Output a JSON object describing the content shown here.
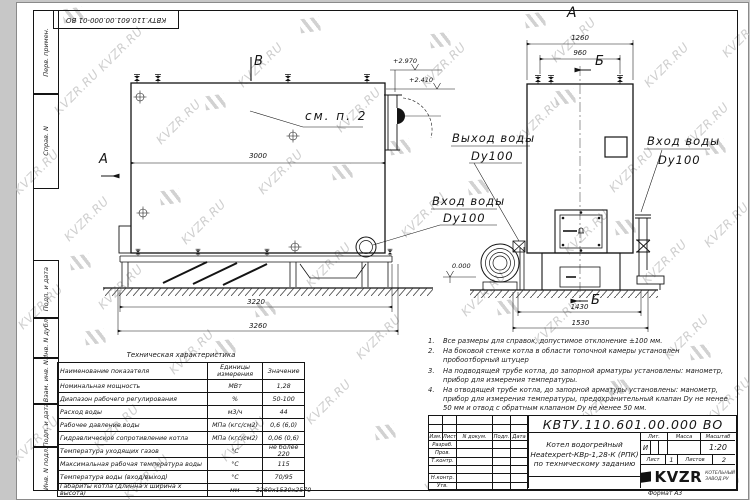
{
  "watermark": {
    "text": "KVZR.RU",
    "color": "#c6c6c6"
  },
  "colors": {
    "paper": "#ffffff",
    "line": "#141414",
    "background": "#c7c7c7"
  },
  "stamp_top": "КВТУ.110.601.00.000-01  ВО",
  "sidebar": {
    "labels": [
      "Перв. примен.",
      "Справ. N",
      "Подп. и дата",
      "Инв. N дубл.",
      "Взам. инв. N",
      "Подп. и дата",
      "Инв. N подл."
    ]
  },
  "side_view": {
    "marker_b": "В",
    "marker_a": "А",
    "elev_top": "+2.970",
    "elev_mid": "+2.410",
    "note_ref": "см. п. 2",
    "dim_width": "3000",
    "dim_base": "3220",
    "dim_total": "3260"
  },
  "front_view": {
    "marker_a": "А",
    "marker_b_top": "Б",
    "marker_b_bottom": "Б",
    "dim_top1": "1260",
    "dim_top2": "960",
    "dim_bot1": "1430",
    "dim_bot2": "1530",
    "elev_zero": "0.000"
  },
  "pipes": {
    "outlet_label": "Выход воды",
    "outlet_dn": "Dy100",
    "inlet_left_label": "Вход воды",
    "inlet_left_dn": "Dy100",
    "inlet_right_label": "Вход воды",
    "inlet_right_dn": "Dy100"
  },
  "notes": [
    {
      "num": "1.",
      "text": "Все размеры для справок, допустимое отклонение ±100 мм."
    },
    {
      "num": "2.",
      "text": "На боковой стенке котла в области топочной камеры установлен пробоотборный штуцер"
    },
    {
      "num": "3.",
      "text": "На подводящей трубе котла, до запорной арматуры установлены: манометр, прибор для измерения температуры."
    },
    {
      "num": "4.",
      "text": "На отводящей трубе котла, до запорной арматуры установлены: манометр, прибор для измерения температуры, предохранительный клапан Dy не менее 50 мм и отвод с обратным клапаном Dy не менее 50 мм."
    }
  ],
  "spec_table": {
    "title": "Техническая характеристика",
    "headers": [
      "Наименование показателя",
      "Единицы измерения",
      "Значение"
    ],
    "rows": [
      {
        "name": "Номинальная мощность",
        "unit": "МВт",
        "value": "1,28"
      },
      {
        "name": "Диапазон рабочего регулирования",
        "unit": "%",
        "value": "50-100"
      },
      {
        "name": "Расход воды",
        "unit": "м3/ч",
        "value": "44"
      },
      {
        "name": "Рабочее давление воды",
        "unit": "МПа (кгс/см2)",
        "value": "0,6 (6,0)"
      },
      {
        "name": "Гидравлическое сопротивление котла",
        "unit": "МПа (кгс/см2)",
        "value": "0,06 (0,6)"
      },
      {
        "name": "Температура уходящих газов",
        "unit": "°С",
        "value": "не более 220"
      },
      {
        "name": "Максимальная рабочая температура воды",
        "unit": "°С",
        "value": "115"
      },
      {
        "name": "Температура воды (вход/выход)",
        "unit": "°С",
        "value": "70/95"
      },
      {
        "name": "Габариты котла (длинна х ширина х высота)",
        "unit": "мм",
        "value": "3260х1530х2570"
      }
    ]
  },
  "title_block": {
    "doc_number": "КВТУ.110.601.00.000  ВО",
    "col_headers": [
      "Изм.",
      "Лист",
      "N докум.",
      "Подп.",
      "Дата"
    ],
    "row_labels": [
      "Разраб.",
      "Пров.",
      "Т.контр.",
      "",
      "Н.контр.",
      "Утв."
    ],
    "title_lines": [
      "Котел водогрейный",
      "Heatexpert-КВр-1,28-К (РПК)",
      "по техническому заданию"
    ],
    "lit_header": "Лит.",
    "mass_header": "Масса",
    "scale_header": "Масштаб",
    "lit_value": "И",
    "mass_value": "",
    "scale_value": "1:20",
    "sheet_label": "Лист",
    "sheet_value": "1",
    "sheets_label": "Листов",
    "sheets_value": "2",
    "logo_text": "KVZR",
    "logo_sub_line1": "КОТЕЛЬНЫЙ",
    "logo_sub_line2": "ЗАВОД.РУ",
    "format_label": "Формат",
    "format_value": "А3"
  }
}
